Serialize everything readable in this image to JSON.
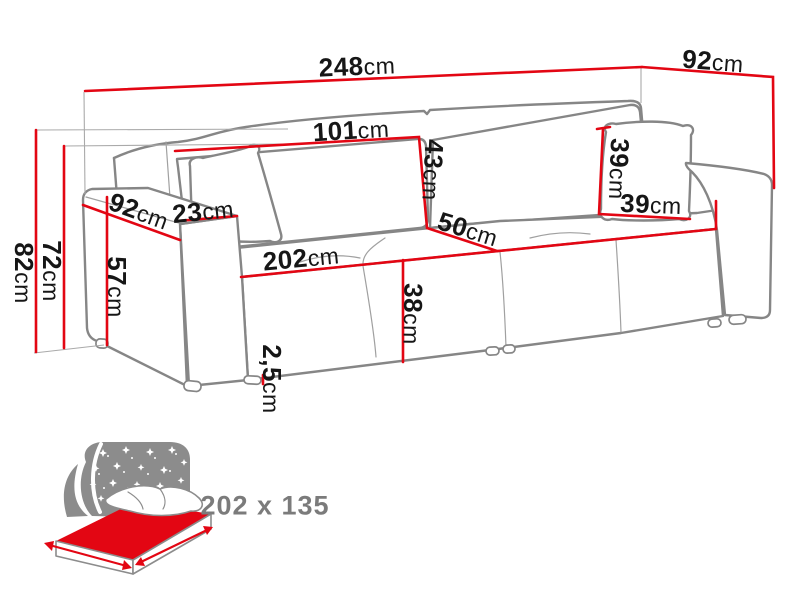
{
  "diagram": {
    "dimensions": {
      "total_width": {
        "value": "248",
        "unit": "cm"
      },
      "total_depth": {
        "value": "92",
        "unit": "cm"
      },
      "back_cushion_width": {
        "value": "101",
        "unit": "cm"
      },
      "back_cushion_height": {
        "value": "43",
        "unit": "cm"
      },
      "pillow_height": {
        "value": "39",
        "unit": "cm"
      },
      "pillow_width": {
        "value": "39",
        "unit": "cm"
      },
      "seat_depth": {
        "value": "50",
        "unit": "cm"
      },
      "armrest_depth": {
        "value": "92",
        "unit": "cm"
      },
      "armrest_width": {
        "value": "23",
        "unit": "cm"
      },
      "seat_width": {
        "value": "202",
        "unit": "cm"
      },
      "seat_height": {
        "value": "38",
        "unit": "cm"
      },
      "armrest_height": {
        "value": "57",
        "unit": "cm"
      },
      "total_height": {
        "value": "82",
        "unit": "cm"
      },
      "frame_height": {
        "value": "72",
        "unit": "cm"
      },
      "leg_height": {
        "value": "2,5",
        "unit": "cm"
      }
    }
  },
  "sleeping_area": {
    "icon": "sleeping-bed-icon",
    "label": "202 x 135"
  },
  "colors": {
    "dimension_line": "#e30613",
    "sofa_outline": "#868686",
    "dimension_text": "#161616",
    "sleeping_label": "#7b7b7b"
  }
}
